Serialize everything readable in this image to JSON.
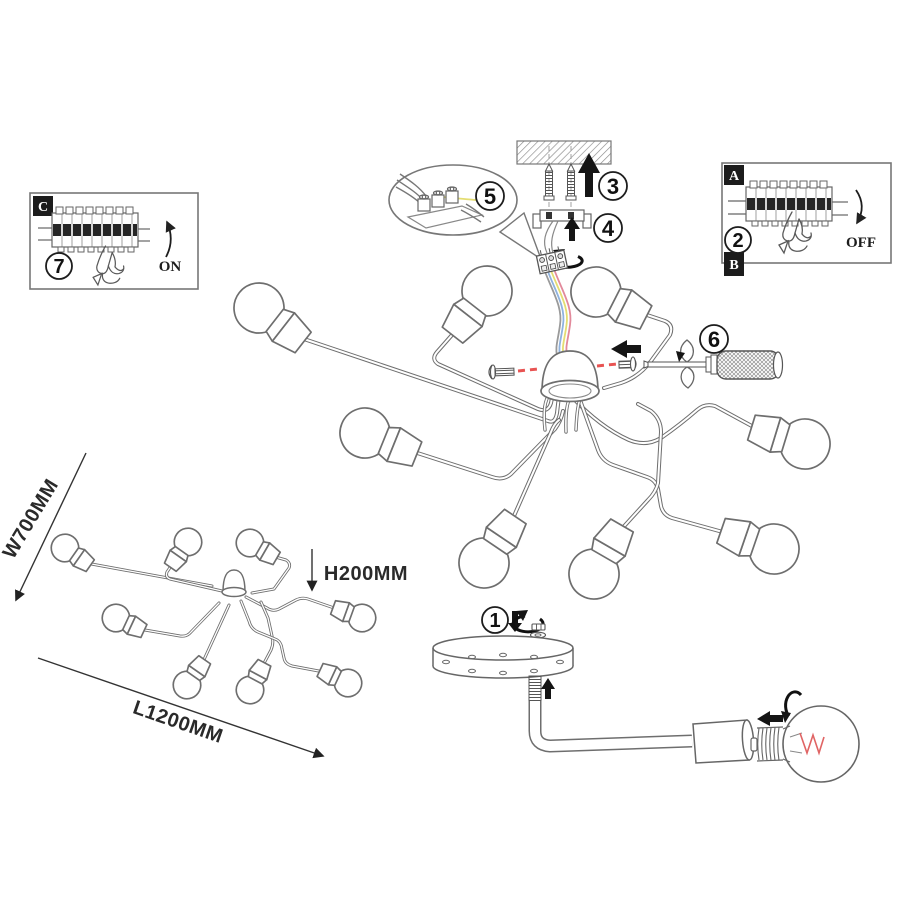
{
  "document": {
    "title": "Ceiling lamp installation instruction diagram",
    "background": "#ffffff"
  },
  "palette": {
    "line": "#6e6e6e",
    "ink": "#151515",
    "red_dash": "#e85352",
    "wire_blue": "#8fb2de",
    "wire_yellow": "#e4dd72",
    "wire_red": "#e2899b",
    "filament_red": "#e06464"
  },
  "steps": {
    "s1": "1",
    "s2": "2",
    "s3": "3",
    "s4": "4",
    "s5": "5",
    "s6": "6",
    "s7": "7"
  },
  "insets": {
    "power_off": {
      "corner_top_label": "A",
      "corner_bottom_label": "B",
      "state_label": "OFF"
    },
    "power_on": {
      "corner_label": "C",
      "state_label": "ON"
    }
  },
  "dimensions": {
    "width_label": "W700MM",
    "length_label": "L1200MM",
    "height_label": "H200MM"
  }
}
